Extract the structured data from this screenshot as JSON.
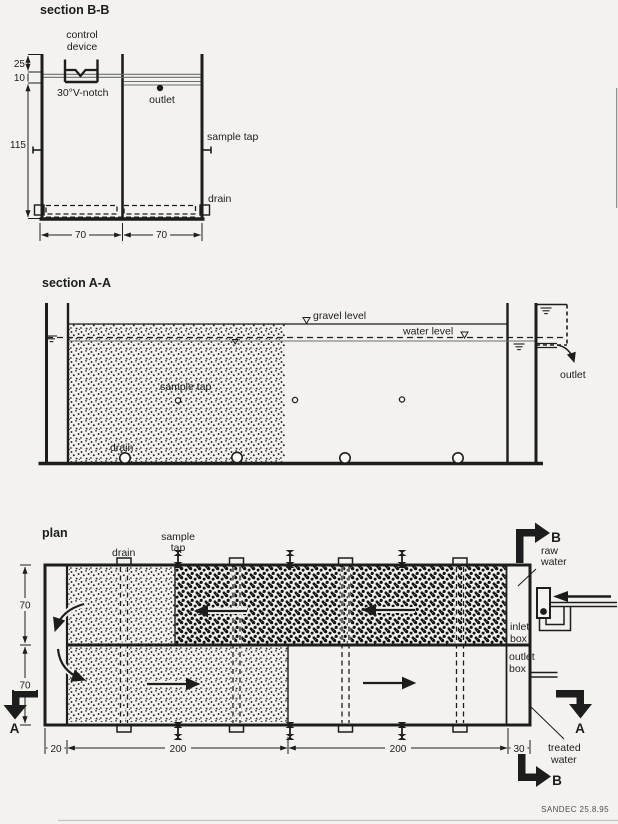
{
  "credit": "SANDEC 25.8.95",
  "colors": {
    "ink": "#1d1d1d",
    "paper": "#f3f2ee"
  },
  "section_bb": {
    "title": "section B-B",
    "control_device": [
      "control",
      "device"
    ],
    "v_notch": "30°V-notch",
    "outlet": "outlet",
    "sample_tap": "sample tap",
    "drain": "drain",
    "dims": {
      "top": "25",
      "mid": "10",
      "depth": "115",
      "cell_left": "70",
      "cell_right": "70"
    }
  },
  "section_aa": {
    "title": "section A-A",
    "gravel_level": "gravel level",
    "water_level": "water level",
    "sample_tap": "sample tap",
    "drain": "drain",
    "outlet": "outlet"
  },
  "plan": {
    "title": "plan",
    "drain": "drain",
    "sample_tap": [
      "sample",
      "tap"
    ],
    "raw_water": [
      "raw",
      "water"
    ],
    "inlet_box": [
      "inlet",
      "box"
    ],
    "outlet_box": [
      "outlet",
      "box"
    ],
    "treated_water": [
      "treated",
      "water"
    ],
    "section_a": "A",
    "section_b": "B",
    "dims": {
      "width_top": "70",
      "width_bottom": "70",
      "inlet_channel": "20",
      "cell1": "200",
      "cell2": "200",
      "outlet_box_w": "30"
    }
  }
}
